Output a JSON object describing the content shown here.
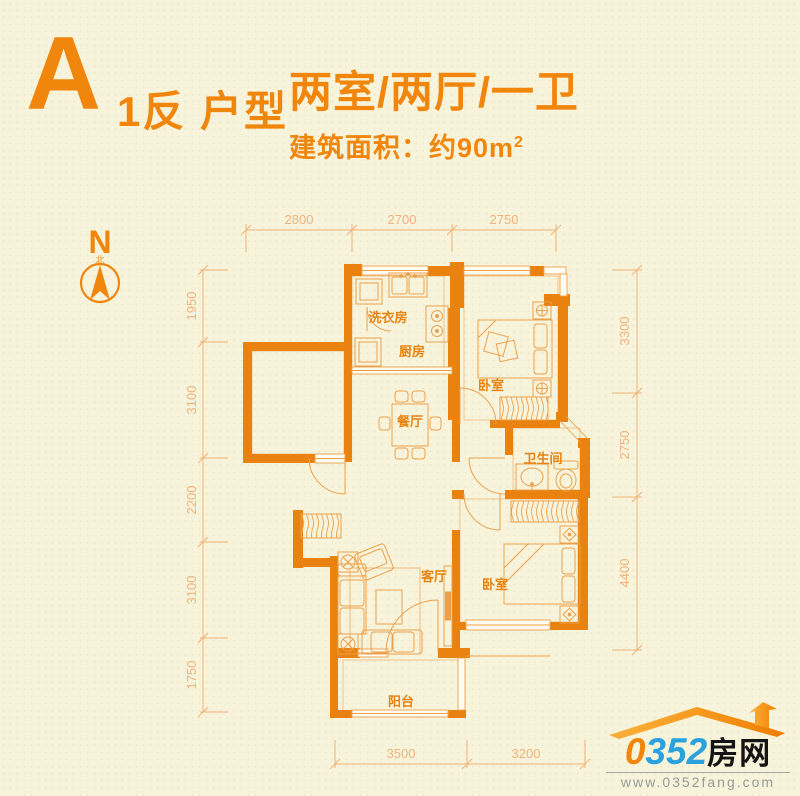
{
  "title": {
    "letter": "A",
    "suffix": "1反 户型",
    "rooms": "两室/两厅/一卫",
    "area": "建筑面积：约90m",
    "area_sup": "2"
  },
  "compass": {
    "n": "N",
    "north": "北"
  },
  "rooms": {
    "laundry": "洗衣房",
    "kitchen": "厨房",
    "bedroom1": "卧室",
    "dining": "餐厅",
    "bath": "卫生间",
    "living": "客厅",
    "bedroom2": "卧室",
    "balcony": "阳台"
  },
  "dimensions": {
    "top": [
      "2800",
      "2700",
      "2750"
    ],
    "left": [
      "1950",
      "3100",
      "2200",
      "3100",
      "1750"
    ],
    "right": [
      "3300",
      "2750",
      "4400"
    ],
    "bottom": [
      "3500",
      "3200"
    ]
  },
  "logo": {
    "zero": "0",
    "digits": "352",
    "cn": "房网",
    "url": "www.0352fang.com"
  },
  "colors": {
    "background": "#f8f4dc",
    "wall_orange": "#e9820e",
    "furniture_line": "#eda04a",
    "dimension": "#efb27a",
    "title_orange": "#f1860d",
    "label_orange": "#e8820f",
    "logo_blue": "#2ba2de",
    "logo_black": "#141414",
    "logo_gray": "#9a9a9a",
    "roof_orange": "#f79a1e"
  }
}
